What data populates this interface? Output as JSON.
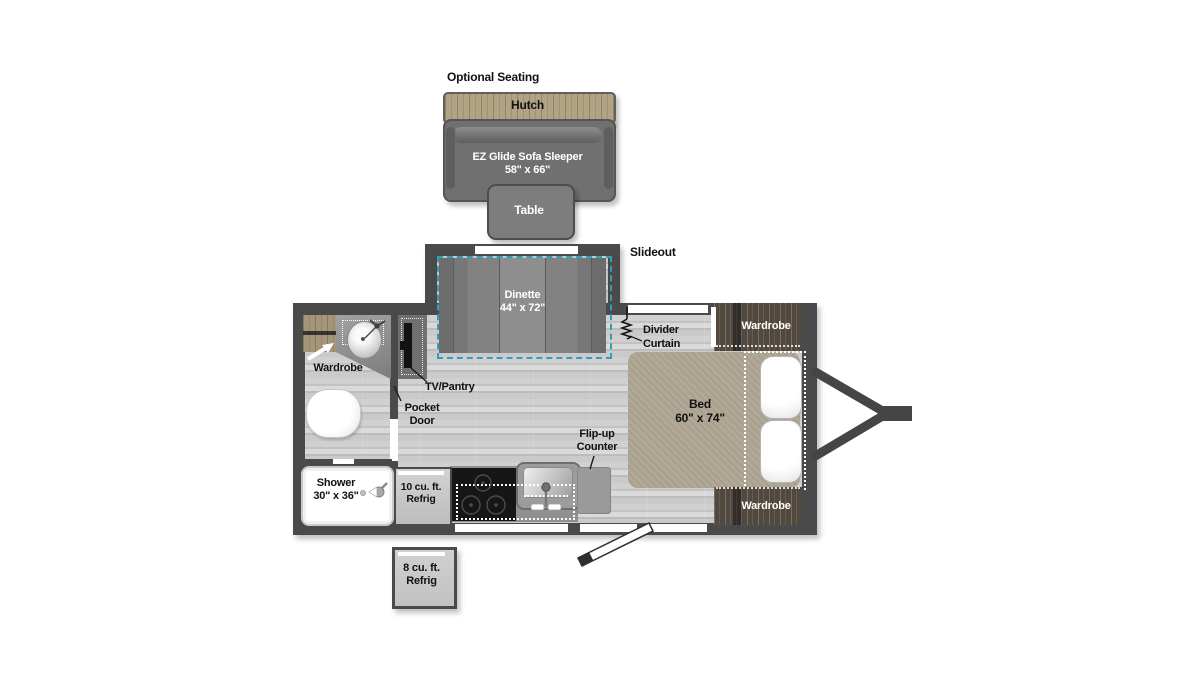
{
  "colors": {
    "wall": "#4a4a4a",
    "floor": "#c8c8c8",
    "wood_light": "#b3a385",
    "wood_dark": "#51493f",
    "bed": "#b1a895",
    "dinette_dash": "#2f9fbc",
    "sofa_gray": "#707070"
  },
  "optional_seating": {
    "title": "Optional Seating",
    "hutch": "Hutch",
    "sofa": "EZ Glide Sofa Sleeper\n58\" x 66\"",
    "table": "Table"
  },
  "slideout": {
    "label": "Slideout",
    "dinette": "Dinette\n44\" x 72\""
  },
  "bedroom": {
    "divider_curtain": "Divider\nCurtain",
    "bed": "Bed\n60\" x 74\"",
    "wardrobe_top": "Wardrobe",
    "wardrobe_bottom": "Wardrobe"
  },
  "bathroom": {
    "wardrobe": "Wardrobe",
    "tv_pantry": "TV/Pantry",
    "pocket_door": "Pocket\nDoor",
    "shower": "Shower\n30\" x 36\""
  },
  "kitchen": {
    "refrig_10": "10 cu. ft.\nRefrig",
    "flip_up_counter": "Flip-up\nCounter",
    "refrig_8": "8 cu. ft.\nRefrig"
  }
}
